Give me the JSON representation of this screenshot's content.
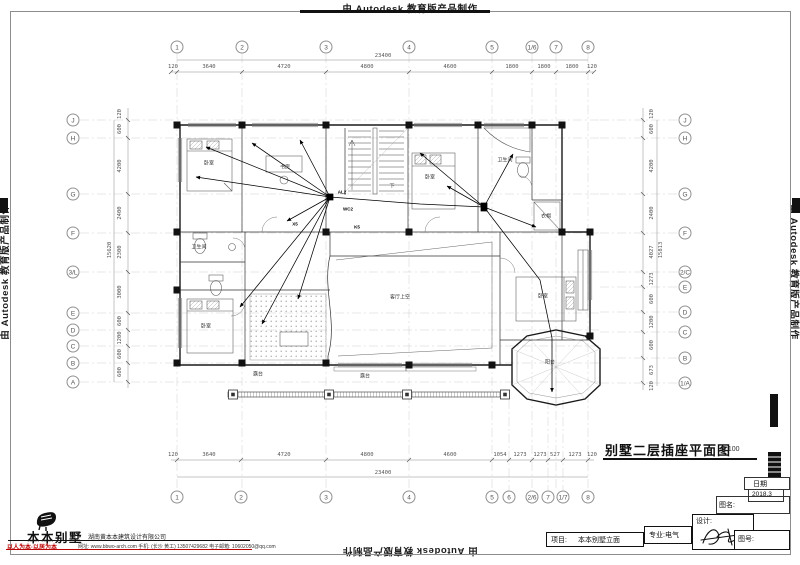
{
  "watermark": {
    "text": "由 Autodesk 教育版产品制作"
  },
  "title": {
    "text": "别墅二层插座平面图",
    "scale": "1:100"
  },
  "title_block": {
    "date_label": "日期",
    "date_value": "2018.3",
    "name_label": "图名:",
    "design_label": "设计:",
    "number_label": "图号:",
    "major_label": "专业:电气",
    "project_label": "项目:",
    "project_value": "本本别墅立面"
  },
  "logo": {
    "name": "本本别墅",
    "company": "湖南黄本本建筑设计有限公司",
    "slogan": "以人为本·以居为本",
    "contact": "网址: www.bbwo-arch.com  手机: (长沙 黄工) 13507429682  电子邮箱: 10602050@qq.com"
  },
  "colors": {
    "accent_red": "#bb0000",
    "line_dark": "#111111"
  },
  "grid": {
    "top": [
      {
        "label": "1",
        "x": 177
      },
      {
        "label": "2",
        "x": 242
      },
      {
        "label": "3",
        "x": 326
      },
      {
        "label": "4",
        "x": 409
      },
      {
        "label": "5",
        "x": 492
      },
      {
        "label": "1/6",
        "x": 532
      },
      {
        "label": "7",
        "x": 556
      },
      {
        "label": "8",
        "x": 588
      }
    ],
    "bottom": [
      {
        "label": "1",
        "x": 177
      },
      {
        "label": "2",
        "x": 241
      },
      {
        "label": "3",
        "x": 326
      },
      {
        "label": "4",
        "x": 409
      },
      {
        "label": "5",
        "x": 492
      },
      {
        "label": "6",
        "x": 509
      },
      {
        "label": "2/6",
        "x": 532
      },
      {
        "label": "7",
        "x": 548
      },
      {
        "label": "1/7",
        "x": 563
      },
      {
        "label": "8",
        "x": 588
      }
    ],
    "left": [
      {
        "label": "J",
        "y": 120
      },
      {
        "label": "H",
        "y": 138
      },
      {
        "label": "G",
        "y": 194
      },
      {
        "label": "F",
        "y": 233
      },
      {
        "label": "3/L",
        "y": 272
      },
      {
        "label": "E",
        "y": 313
      },
      {
        "label": "D",
        "y": 330
      },
      {
        "label": "C",
        "y": 346
      },
      {
        "label": "B",
        "y": 363
      },
      {
        "label": "A",
        "y": 382
      }
    ],
    "right": [
      {
        "label": "J",
        "y": 120
      },
      {
        "label": "H",
        "y": 138
      },
      {
        "label": "G",
        "y": 194
      },
      {
        "label": "F",
        "y": 233
      },
      {
        "label": "2/C",
        "y": 272
      },
      {
        "label": "E",
        "y": 287
      },
      {
        "label": "D",
        "y": 312
      },
      {
        "label": "C",
        "y": 332
      },
      {
        "label": "B",
        "y": 358
      },
      {
        "label": "1/A",
        "y": 383
      }
    ]
  },
  "dims": {
    "top": [
      {
        "v": "120",
        "x": 173
      },
      {
        "v": "3640",
        "x": 209
      },
      {
        "v": "4720",
        "x": 284
      },
      {
        "v": "4800",
        "x": 367
      },
      {
        "v": "4600",
        "x": 450
      },
      {
        "v": "1800",
        "x": 512
      },
      {
        "v": "1800",
        "x": 544
      },
      {
        "v": "1800",
        "x": 572
      },
      {
        "v": "120",
        "x": 592
      }
    ],
    "top_overall": {
      "v": "23400"
    },
    "bottom": [
      {
        "v": "120",
        "x": 173
      },
      {
        "v": "3640",
        "x": 209
      },
      {
        "v": "4720",
        "x": 284
      },
      {
        "v": "4800",
        "x": 367
      },
      {
        "v": "4600",
        "x": 450
      },
      {
        "v": "1054",
        "x": 500
      },
      {
        "v": "1273",
        "x": 520
      },
      {
        "v": "1273",
        "x": 540
      },
      {
        "v": "527",
        "x": 555
      },
      {
        "v": "1273",
        "x": 575
      },
      {
        "v": "120",
        "x": 592
      }
    ],
    "bottom_overall": {
      "v": "23400"
    },
    "left": [
      {
        "v": "120",
        "y": 114
      },
      {
        "v": "600",
        "y": 129
      },
      {
        "v": "4200",
        "y": 166
      },
      {
        "v": "2400",
        "y": 213
      },
      {
        "v": "2300",
        "y": 252
      },
      {
        "v": "3000",
        "y": 292
      },
      {
        "v": "600",
        "y": 321
      },
      {
        "v": "1200",
        "y": 338
      },
      {
        "v": "600",
        "y": 354
      },
      {
        "v": "600",
        "y": 372
      }
    ],
    "left_overall": {
      "v": "15620"
    },
    "right": [
      {
        "v": "120",
        "y": 114
      },
      {
        "v": "600",
        "y": 129
      },
      {
        "v": "4200",
        "y": 166
      },
      {
        "v": "2400",
        "y": 213
      },
      {
        "v": "4027",
        "y": 252
      },
      {
        "v": "1273",
        "y": 279
      },
      {
        "v": "600",
        "y": 299
      },
      {
        "v": "1200",
        "y": 322
      },
      {
        "v": "600",
        "y": 345
      },
      {
        "v": "673",
        "y": 370
      },
      {
        "v": "120",
        "y": 386
      }
    ],
    "right_overall": {
      "v": "15813"
    }
  },
  "plan_labels": [
    {
      "t": "卧室",
      "x": 209,
      "y": 163
    },
    {
      "t": "书房",
      "x": 285,
      "y": 167
    },
    {
      "t": "下",
      "x": 392,
      "y": 186
    },
    {
      "t": "卧室",
      "x": 430,
      "y": 177
    },
    {
      "t": "卫生间",
      "x": 505,
      "y": 160
    },
    {
      "t": "衣帽",
      "x": 546,
      "y": 216
    },
    {
      "t": "卫生间",
      "x": 199,
      "y": 247
    },
    {
      "t": "卧室",
      "x": 206,
      "y": 326
    },
    {
      "t": "客厅上空",
      "x": 400,
      "y": 297
    },
    {
      "t": "卧室",
      "x": 543,
      "y": 296
    },
    {
      "t": "露台",
      "x": 258,
      "y": 374
    },
    {
      "t": "露台",
      "x": 365,
      "y": 376
    },
    {
      "t": "阳台",
      "x": 550,
      "y": 362
    }
  ],
  "wire_labels": [
    {
      "t": "AL2",
      "x": 342,
      "y": 192
    },
    {
      "t": "WC2",
      "x": 348,
      "y": 209
    },
    {
      "t": "X5",
      "x": 295,
      "y": 224
    },
    {
      "t": "K5",
      "x": 357,
      "y": 227
    }
  ]
}
